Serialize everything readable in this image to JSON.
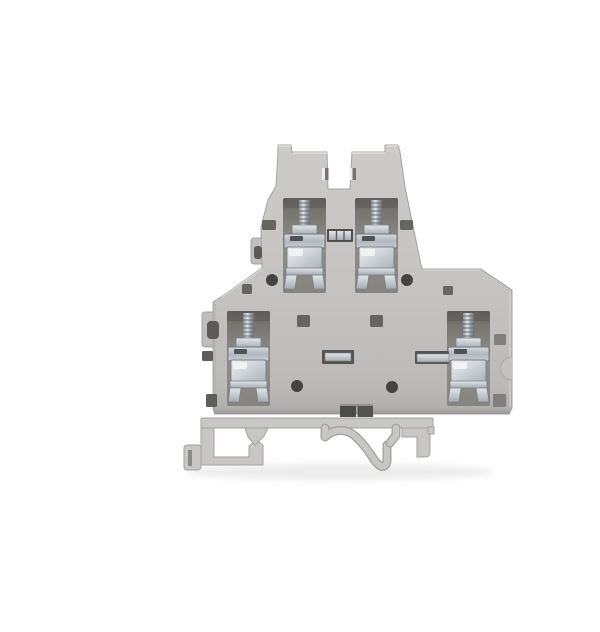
{
  "image": {
    "type": "product-photograph",
    "subject": "Gray double-level DIN rail screw terminal block, side profile view on white background",
    "view": "side profile",
    "background": "seamless white"
  },
  "object": {
    "category": "electrical terminal block",
    "body_material": "light gray molded plastic",
    "level_count": 2,
    "terminal_count": 4,
    "levels": [
      {
        "name": "upper level",
        "terminals": 2,
        "features": [
          "two top towers with center notch",
          "metal jumper link between terminals",
          "two vent slits",
          "two side slots",
          "two round test holes"
        ]
      },
      {
        "name": "lower level",
        "terminals": 2,
        "features": [
          "two center jumper-bar slots with metal bars",
          "cross busbar into right terminal",
          "two square vent slots",
          "two round test holes",
          "edge latch notches"
        ]
      }
    ],
    "terminal_type": "screw clamp with zinc-plated screw, collar and steel yoke with splayed feet",
    "mounting": "DIN rail foot with left hook, center spring clip and right latch block",
    "bottom_feature": "two dark square jumper sockets at bottom center"
  },
  "parts": {
    "upper_left_terminal": "upper left screw clamp terminal",
    "upper_right_terminal": "upper right screw clamp terminal",
    "lower_left_terminal": "lower left screw clamp terminal",
    "lower_right_terminal": "lower right screw clamp terminal",
    "jumper_link": "metal jumper link between upper terminals",
    "jumper_slot_left": "left jumper bar slot",
    "jumper_slot_right": "right jumper bar slot with busbar",
    "din_foot": "DIN rail mounting foot with spring clip"
  },
  "colors": {
    "bg": "#ffffff",
    "body": "#c6c4c2",
    "bodyLight": "#d6d4d2",
    "bodyDark": "#aeacaa",
    "edge": "#a4a2a0",
    "foot": "#c9c7c5",
    "cavity": "#8b8a86",
    "cavityDark": "#6f6e6a",
    "slot": "#66655f",
    "hole": "#454442",
    "notch": "#5c5b58",
    "metalBright": "#e3e6e9",
    "metalMid": "#a6acb2",
    "metalDark": "#767c82"
  }
}
